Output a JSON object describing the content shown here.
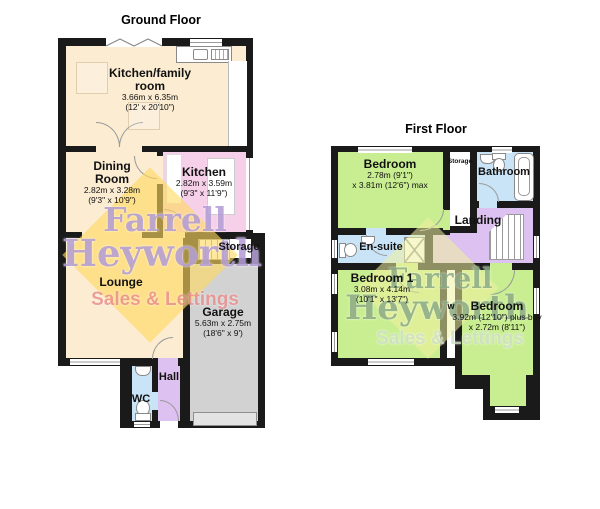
{
  "document": {
    "type": "estate-agent floor plan"
  },
  "colors": {
    "wall": "#1a1a1a",
    "cream": "#fbecd2",
    "pink": "#f6cfe9",
    "green": "#c9ee91",
    "purple": "#ddc1f0",
    "blue": "#c9e4f6",
    "garage": "#d2d2d2",
    "garage_door": "#e3e3e3",
    "gf_diamond": "#ffd95e",
    "gf_name_text": "#b49fd6",
    "gf_sales_text": "#ea8b8b",
    "ff_diamond": "#eef09e",
    "ff_name_text": "#8cab87",
    "ff_sales_text": "#cfdfc9"
  },
  "watermark": {
    "line1": "Farrell",
    "line2": "Heyworth",
    "line3": "Sales & Lettings"
  },
  "floors": {
    "ground": {
      "title": "Ground Floor",
      "rooms": {
        "kitchen_family": {
          "label1": "Kitchen/family",
          "label2": "room",
          "dim1": "3.66m x 6.35m",
          "dim2": "(12' x 20'10\")"
        },
        "dining": {
          "label1": "Dining",
          "label2": "Room",
          "dim1": "2.82m x 3.28m",
          "dim2": "(9'3\" x 10'9\")"
        },
        "kitchen": {
          "label1": "Kitchen",
          "dim1": "2.82m x 3.59m",
          "dim2": "(9'3\" x 11'9\")"
        },
        "storage": {
          "label1": "Storage"
        },
        "lounge": {
          "label1": "Lounge"
        },
        "garage": {
          "label1": "Garage",
          "dim1": "5.63m x 2.75m",
          "dim2": "(18'6\" x 9')"
        },
        "wc": {
          "label1": "WC"
        },
        "hall": {
          "label1": "Hall"
        }
      }
    },
    "first": {
      "title": "First Floor",
      "rooms": {
        "bedroom_top": {
          "label1": "Bedroom",
          "dim1": "2.78m (9'1\")",
          "dim2": "x 3.81m (12'6\") max"
        },
        "storage": {
          "label1": "Storage"
        },
        "bathroom": {
          "label1": "Bathroom"
        },
        "ensuite": {
          "label1": "En-suite"
        },
        "landing": {
          "label1": "Landing"
        },
        "bedroom1": {
          "label1": "Bedroom 1",
          "dim1": "3.08m x 4.14m",
          "dim2": "(10'1\" x 13'7\")"
        },
        "bedroom_right": {
          "label1": "Bedroom",
          "dim1": "3.92m (12'10\") plus bay",
          "dim2": "x 2.72m (8'11\")"
        },
        "wardrobe": {
          "label1": "w"
        }
      }
    }
  }
}
